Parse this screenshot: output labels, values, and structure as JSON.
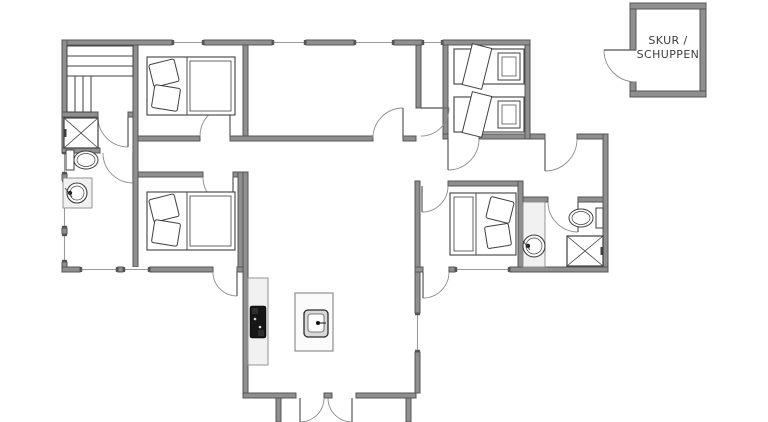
{
  "shed": {
    "label_line1": "SKUR /",
    "label_line2": "SCHUPPEN"
  },
  "colors": {
    "wall": "#8f8f8f",
    "wall_edge": "#555555",
    "window": "#9a9a9a",
    "door_leaf": "#6f6f6f",
    "door_arc": "#8c8c8c",
    "line": "#3f3f3f",
    "counter": "#f1f1f1",
    "cooktop": "#161616",
    "island": "#fbfbfb",
    "background": "#ffffff",
    "label": "#3c3c3c"
  },
  "floorplan": {
    "walls": [
      [
        62,
        40,
        110,
        5
      ],
      [
        204,
        40,
        68,
        5
      ],
      [
        306,
        40,
        48,
        5
      ],
      [
        394,
        40,
        28,
        5
      ],
      [
        443,
        40,
        87,
        5
      ],
      [
        62,
        40,
        5,
        112
      ],
      [
        62,
        174,
        5,
        6
      ],
      [
        62,
        228,
        5,
        6
      ],
      [
        62,
        262,
        5,
        10
      ],
      [
        62,
        267,
        18,
        5
      ],
      [
        118,
        267,
        5,
        5
      ],
      [
        150,
        267,
        63,
        5
      ],
      [
        237,
        267,
        11,
        5
      ],
      [
        133,
        45,
        5,
        222
      ],
      [
        62,
        112,
        36,
        5
      ],
      [
        128,
        112,
        5,
        5
      ],
      [
        62,
        148,
        38,
        5
      ],
      [
        138,
        136,
        62,
        5
      ],
      [
        230,
        136,
        143,
        5
      ],
      [
        403,
        136,
        13,
        5
      ],
      [
        138,
        172,
        65,
        5
      ],
      [
        233,
        172,
        10,
        5
      ],
      [
        238,
        172,
        5,
        95
      ],
      [
        243,
        45,
        5,
        91
      ],
      [
        243,
        172,
        5,
        221
      ],
      [
        243,
        393,
        53,
        5
      ],
      [
        324,
        393,
        8,
        5
      ],
      [
        356,
        393,
        60,
        5
      ],
      [
        276,
        398,
        5,
        24
      ],
      [
        406,
        398,
        5,
        24
      ],
      [
        416,
        45,
        5,
        63
      ],
      [
        443,
        45,
        5,
        89
      ],
      [
        525,
        45,
        5,
        94
      ],
      [
        443,
        134,
        5,
        5
      ],
      [
        479,
        134,
        46,
        5
      ],
      [
        530,
        134,
        15,
        5
      ],
      [
        577,
        134,
        26,
        5
      ],
      [
        603,
        134,
        5,
        138
      ],
      [
        415,
        267,
        8,
        5
      ],
      [
        449,
        267,
        6,
        5
      ],
      [
        510,
        267,
        98,
        5
      ],
      [
        415,
        181,
        5,
        86
      ],
      [
        415,
        272,
        5,
        41
      ],
      [
        415,
        352,
        5,
        41
      ],
      [
        448,
        181,
        70,
        5
      ],
      [
        518,
        181,
        5,
        86
      ],
      [
        523,
        197,
        25,
        5
      ],
      [
        578,
        197,
        25,
        5
      ],
      [
        630,
        3,
        76,
        6
      ],
      [
        700,
        9,
        6,
        82
      ],
      [
        630,
        91,
        76,
        6
      ],
      [
        630,
        9,
        6,
        41
      ],
      [
        630,
        82,
        6,
        9
      ]
    ],
    "windows": [
      [
        172,
        40,
        32,
        5,
        "h"
      ],
      [
        272,
        40,
        34,
        5,
        "h"
      ],
      [
        354,
        40,
        40,
        5,
        "h"
      ],
      [
        422,
        40,
        21,
        5,
        "h"
      ],
      [
        62,
        152,
        5,
        22,
        "v"
      ],
      [
        62,
        180,
        5,
        48,
        "v"
      ],
      [
        62,
        234,
        5,
        28,
        "v"
      ],
      [
        80,
        267,
        38,
        5,
        "h"
      ],
      [
        123,
        267,
        27,
        5,
        "h"
      ],
      [
        455,
        267,
        55,
        5,
        "h"
      ],
      [
        415,
        313,
        5,
        39,
        "v"
      ]
    ],
    "doors": [
      {
        "name": "sauna-door",
        "leaf": [
          128,
          117,
          128,
          147
        ],
        "arc": [
          98,
          117,
          30,
          128,
          147,
          0
        ]
      },
      {
        "name": "bathroom-left-door",
        "leaf": [
          133,
          153,
          133,
          183
        ],
        "arc": [
          103,
          153,
          30,
          133,
          183,
          0
        ]
      },
      {
        "name": "bedroom-top-left-door",
        "leaf": [
          230,
          136,
          230,
          106
        ],
        "arc": [
          200,
          136,
          30,
          230,
          106,
          1
        ]
      },
      {
        "name": "bedroom-bottom-left-door",
        "leaf": [
          233,
          177,
          233,
          207
        ],
        "arc": [
          203,
          177,
          30,
          233,
          207,
          0
        ]
      },
      {
        "name": "terrace-door-left",
        "leaf": [
          237,
          272,
          237,
          296
        ],
        "arc": [
          213,
          272,
          24,
          237,
          296,
          0
        ]
      },
      {
        "name": "living-dining-door",
        "leaf": [
          403,
          138,
          403,
          108
        ],
        "arc": [
          373,
          138,
          30,
          403,
          108,
          1
        ]
      },
      {
        "name": "living-hall-door",
        "leaf": [
          421,
          108,
          449,
          108
        ],
        "arc": [
          421,
          136,
          28,
          449,
          108,
          0
        ]
      },
      {
        "name": "twin-bedroom-door",
        "leaf": [
          448,
          139,
          448,
          170
        ],
        "arc": [
          479,
          139,
          31,
          448,
          170,
          1
        ]
      },
      {
        "name": "wing-entrance-door",
        "leaf": [
          545,
          139,
          545,
          171
        ],
        "arc": [
          577,
          139,
          32,
          545,
          171,
          1
        ]
      },
      {
        "name": "bathroom-right-door",
        "leaf": [
          578,
          202,
          578,
          232
        ],
        "arc": [
          548,
          202,
          30,
          578,
          232,
          0
        ]
      },
      {
        "name": "bedroom-right-door",
        "leaf": [
          422,
          186,
          422,
          212
        ],
        "arc": [
          448,
          186,
          26,
          422,
          212,
          1
        ]
      },
      {
        "name": "terrace-door-right",
        "leaf": [
          423,
          272,
          423,
          298
        ],
        "arc": [
          449,
          272,
          26,
          423,
          298,
          1
        ]
      },
      {
        "name": "entrance-door-left",
        "leaf": [
          300,
          398,
          300,
          422
        ],
        "arc": [
          324,
          398,
          24,
          300,
          422,
          1
        ]
      },
      {
        "name": "entrance-door-right",
        "leaf": [
          352,
          398,
          352,
          422
        ],
        "arc": [
          328,
          398,
          24,
          352,
          422,
          0
        ]
      },
      {
        "name": "shed-door",
        "leaf": [
          636,
          50,
          604,
          50
        ],
        "arc": [
          604,
          50,
          32,
          636,
          82,
          0
        ]
      }
    ],
    "fixtures": [
      {
        "type": "slats",
        "name": "sauna-bench-top",
        "rect": [
          67,
          46,
          66,
          30
        ],
        "dir": "h"
      },
      {
        "type": "slats",
        "name": "sauna-bench-side",
        "rect": [
          67,
          76,
          24,
          36
        ],
        "dir": "v"
      },
      {
        "type": "shower",
        "name": "shower-stall-left",
        "rect": [
          64,
          118,
          34,
          30
        ],
        "tick": "left"
      },
      {
        "type": "toilet",
        "name": "toilet-left",
        "tank": [
          66,
          150,
          8,
          20
        ],
        "bowl": [
          86,
          160,
          12,
          9
        ]
      },
      {
        "type": "basin",
        "name": "washbasin-left",
        "counter": [
          63,
          178,
          29,
          30
        ],
        "circle": [
          77,
          193,
          10
        ],
        "dot": [
          70,
          193
        ]
      },
      {
        "type": "bed2",
        "name": "double-bed-top-left",
        "rect": [
          147,
          57,
          88,
          58
        ],
        "head": "left"
      },
      {
        "type": "bed2",
        "name": "double-bed-bottom-left",
        "rect": [
          147,
          192,
          88,
          58
        ],
        "head": "left"
      },
      {
        "type": "bed2",
        "name": "double-bed-right",
        "rect": [
          450,
          193,
          66,
          62
        ],
        "head": "right"
      },
      {
        "type": "bed1",
        "name": "single-bed-top",
        "rect": [
          454,
          49,
          70,
          35
        ]
      },
      {
        "type": "bed1",
        "name": "single-bed-bottom",
        "rect": [
          454,
          97,
          70,
          35
        ]
      },
      {
        "type": "counter",
        "name": "kitchen-counter",
        "rect": [
          248,
          278,
          20,
          87
        ]
      },
      {
        "type": "cooktop",
        "name": "cooktop",
        "rect": [
          250,
          306,
          16,
          32
        ]
      },
      {
        "type": "island",
        "name": "kitchen-island",
        "rect": [
          295,
          293,
          38,
          58
        ]
      },
      {
        "type": "sink",
        "name": "kitchen-sink",
        "rect": [
          304,
          310,
          24,
          27
        ]
      },
      {
        "type": "basin",
        "name": "washbasin-right",
        "counter": [
          523,
          202,
          22,
          65
        ],
        "circle": [
          534,
          246,
          11
        ],
        "dot": [
          528,
          246
        ]
      },
      {
        "type": "toilet",
        "name": "toilet-right",
        "tank": [
          596,
          208,
          7,
          20
        ],
        "bowl": [
          581,
          218,
          12,
          9
        ]
      },
      {
        "type": "shower",
        "name": "shower-stall-right",
        "rect": [
          567,
          236,
          36,
          30
        ],
        "tick": "right"
      }
    ]
  }
}
